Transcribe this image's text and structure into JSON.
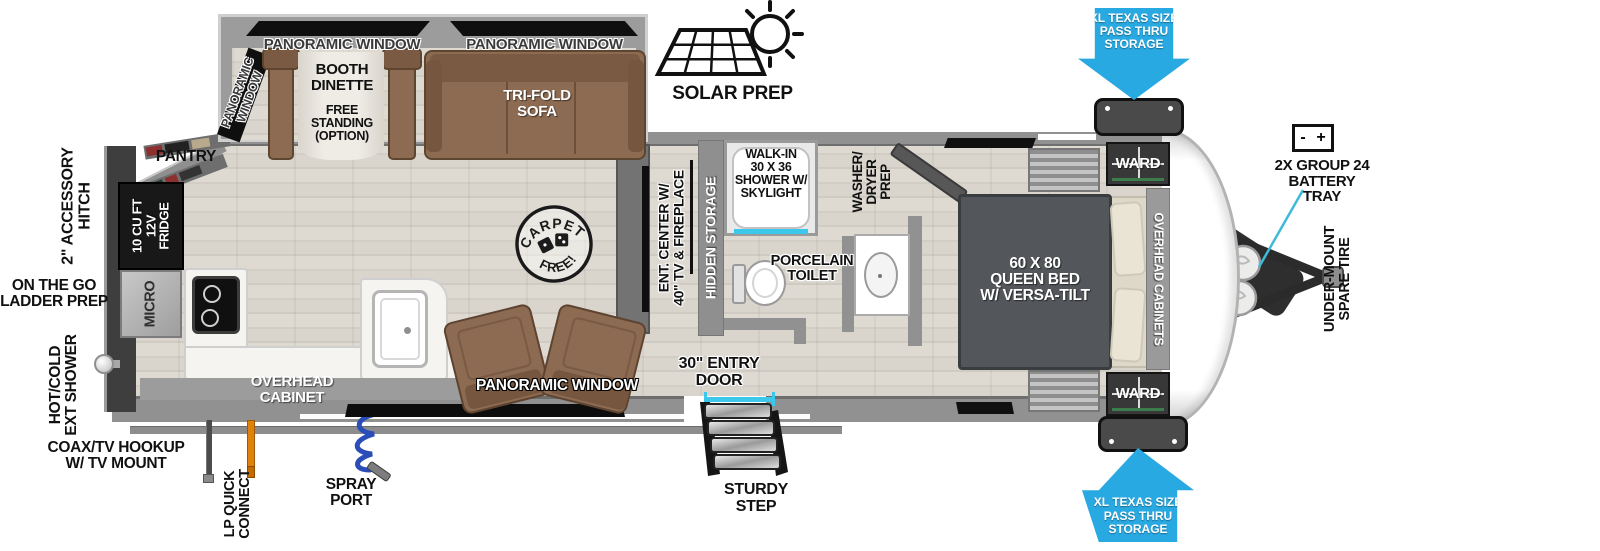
{
  "diagram": {
    "title": "travel trailer floorplan",
    "colors": {
      "arrow_blue": "#29a9e1",
      "accent_cyan": "#3cc8ea",
      "furniture_brown": "#8c6b52",
      "bed_gray": "#53565a",
      "wall_gray": "#919191",
      "appliance_black": "#161616",
      "lp_orange": "#e0820a",
      "hose_blue": "#2b4db8"
    }
  },
  "exterior": {
    "accessory_hitch": "2\" ACCESSORY\nHITCH",
    "ladder_prep": "ON THE GO\nLADDER PREP",
    "ext_shower": "HOT/COLD\nEXT SHOWER",
    "coax_hookup": "COAX/TV HOOKUP\nW/ TV MOUNT",
    "lp_quick_connect": "LP QUICK\nCONNECT",
    "spray_port": "SPRAY\nPORT",
    "solar_prep": "SOLAR PREP",
    "entry_door": "30\" ENTRY\nDOOR",
    "sturdy_step": "STURDY\nSTEP",
    "pass_thru_top": "XL TEXAS SIZE\nPASS THRU\nSTORAGE",
    "pass_thru_bottom": "XL TEXAS SIZE\nPASS THRU\nSTORAGE",
    "battery_tray": "2X GROUP 24\nBATTERY\nTRAY",
    "battery_minus": "-",
    "battery_plus": "+",
    "spare_tire": "UNDER-MOUNT\nSPARE TIRE"
  },
  "slideout": {
    "panoramic_window_left": "PANORAMIC WINDOW",
    "panoramic_window_right": "PANORAMIC WINDOW",
    "panoramic_window_side": "PANORAMIC\nWINDOW",
    "booth_dinette": "BOOTH\nDINETTE",
    "booth_option": "FREE\nSTANDING\n(OPTION)",
    "trifold_sofa": "TRI-FOLD\nSOFA"
  },
  "kitchen": {
    "pantry": "PANTRY",
    "fridge": "10 CU FT\n12V\nFRIDGE",
    "micro": "MICRO",
    "overhead_cabinet": "OVERHEAD\nCABINET",
    "panoramic_window": "PANORAMIC WINDOW",
    "carpet_free_top": "CARPET",
    "carpet_free_bottom": "FREE!"
  },
  "living": {
    "ent_center": "ENT. CENTER W/\n40\" TV & FIREPLACE",
    "hidden_storage": "HIDDEN STORAGE"
  },
  "bath": {
    "shower": "WALK-IN\n30 X 36\nSHOWER W/\nSKYLIGHT",
    "toilet": "PORCELAIN\nTOILET",
    "washer_dryer": "WASHER/\nDRYER\nPREP"
  },
  "bedroom": {
    "queen_bed": "60 X  80\nQUEEN BED\nW/ VERSA-TILT",
    "ward_top": "WARD",
    "ward_bottom": "WARD",
    "overhead_cabinets": "OVERHEAD CABINETS"
  }
}
